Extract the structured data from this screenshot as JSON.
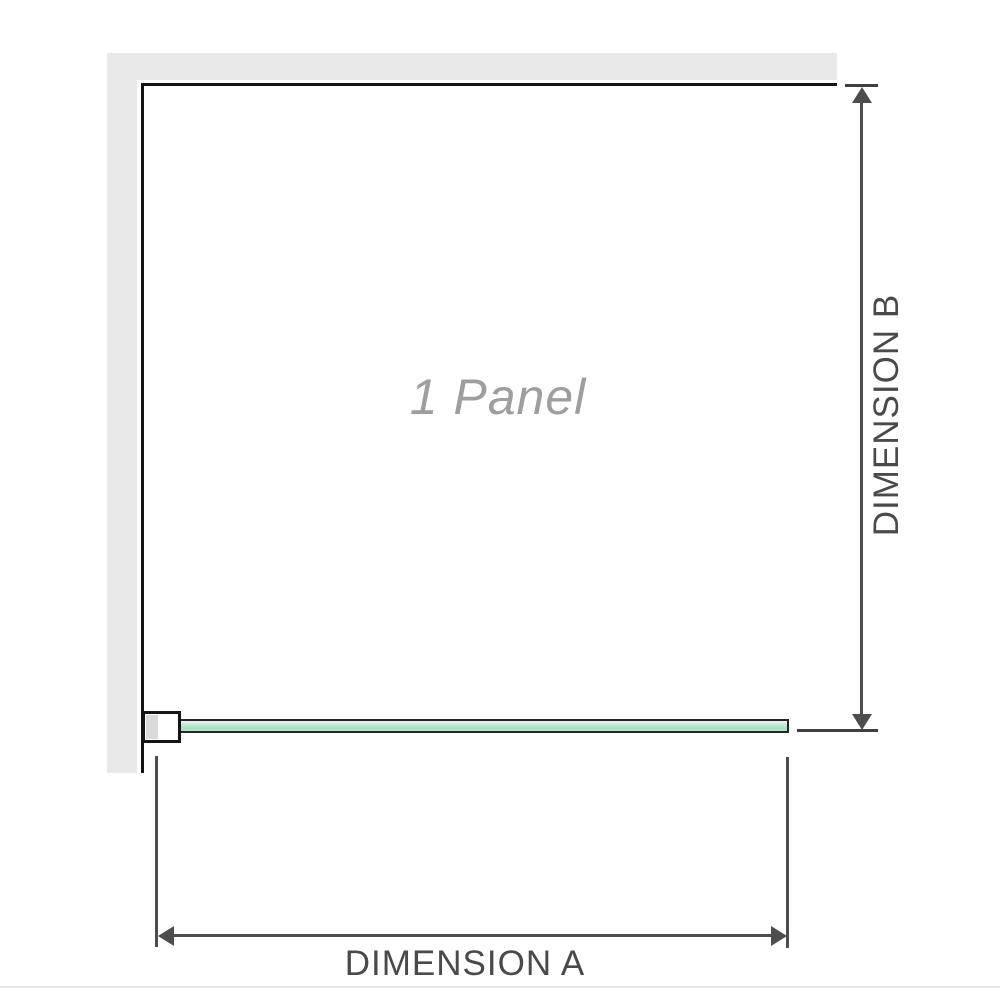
{
  "diagram": {
    "title": "Shower screen single panel dimension diagram",
    "panel_label": "1 Panel",
    "dimension_a": {
      "label": "DIMENSION A",
      "orientation": "horizontal",
      "measures": "panel width"
    },
    "dimension_b": {
      "label": "DIMENSION B",
      "orientation": "vertical",
      "measures": "panel height"
    }
  },
  "colors": {
    "background": "#ffffff",
    "wall": "#e9e9e9",
    "panel_outline": "#141414",
    "glass_fill": "#aadfc1",
    "glass_highlight": "#e8f7ee",
    "glass_border": "#262626",
    "bracket_border": "#141414",
    "bracket_pad": "#d9d9d9",
    "dimension_line": "#4d4d4d",
    "dimension_text": "#4a4a4a",
    "panel_text": "#9e9e9e",
    "divider": "#e8e5df"
  }
}
